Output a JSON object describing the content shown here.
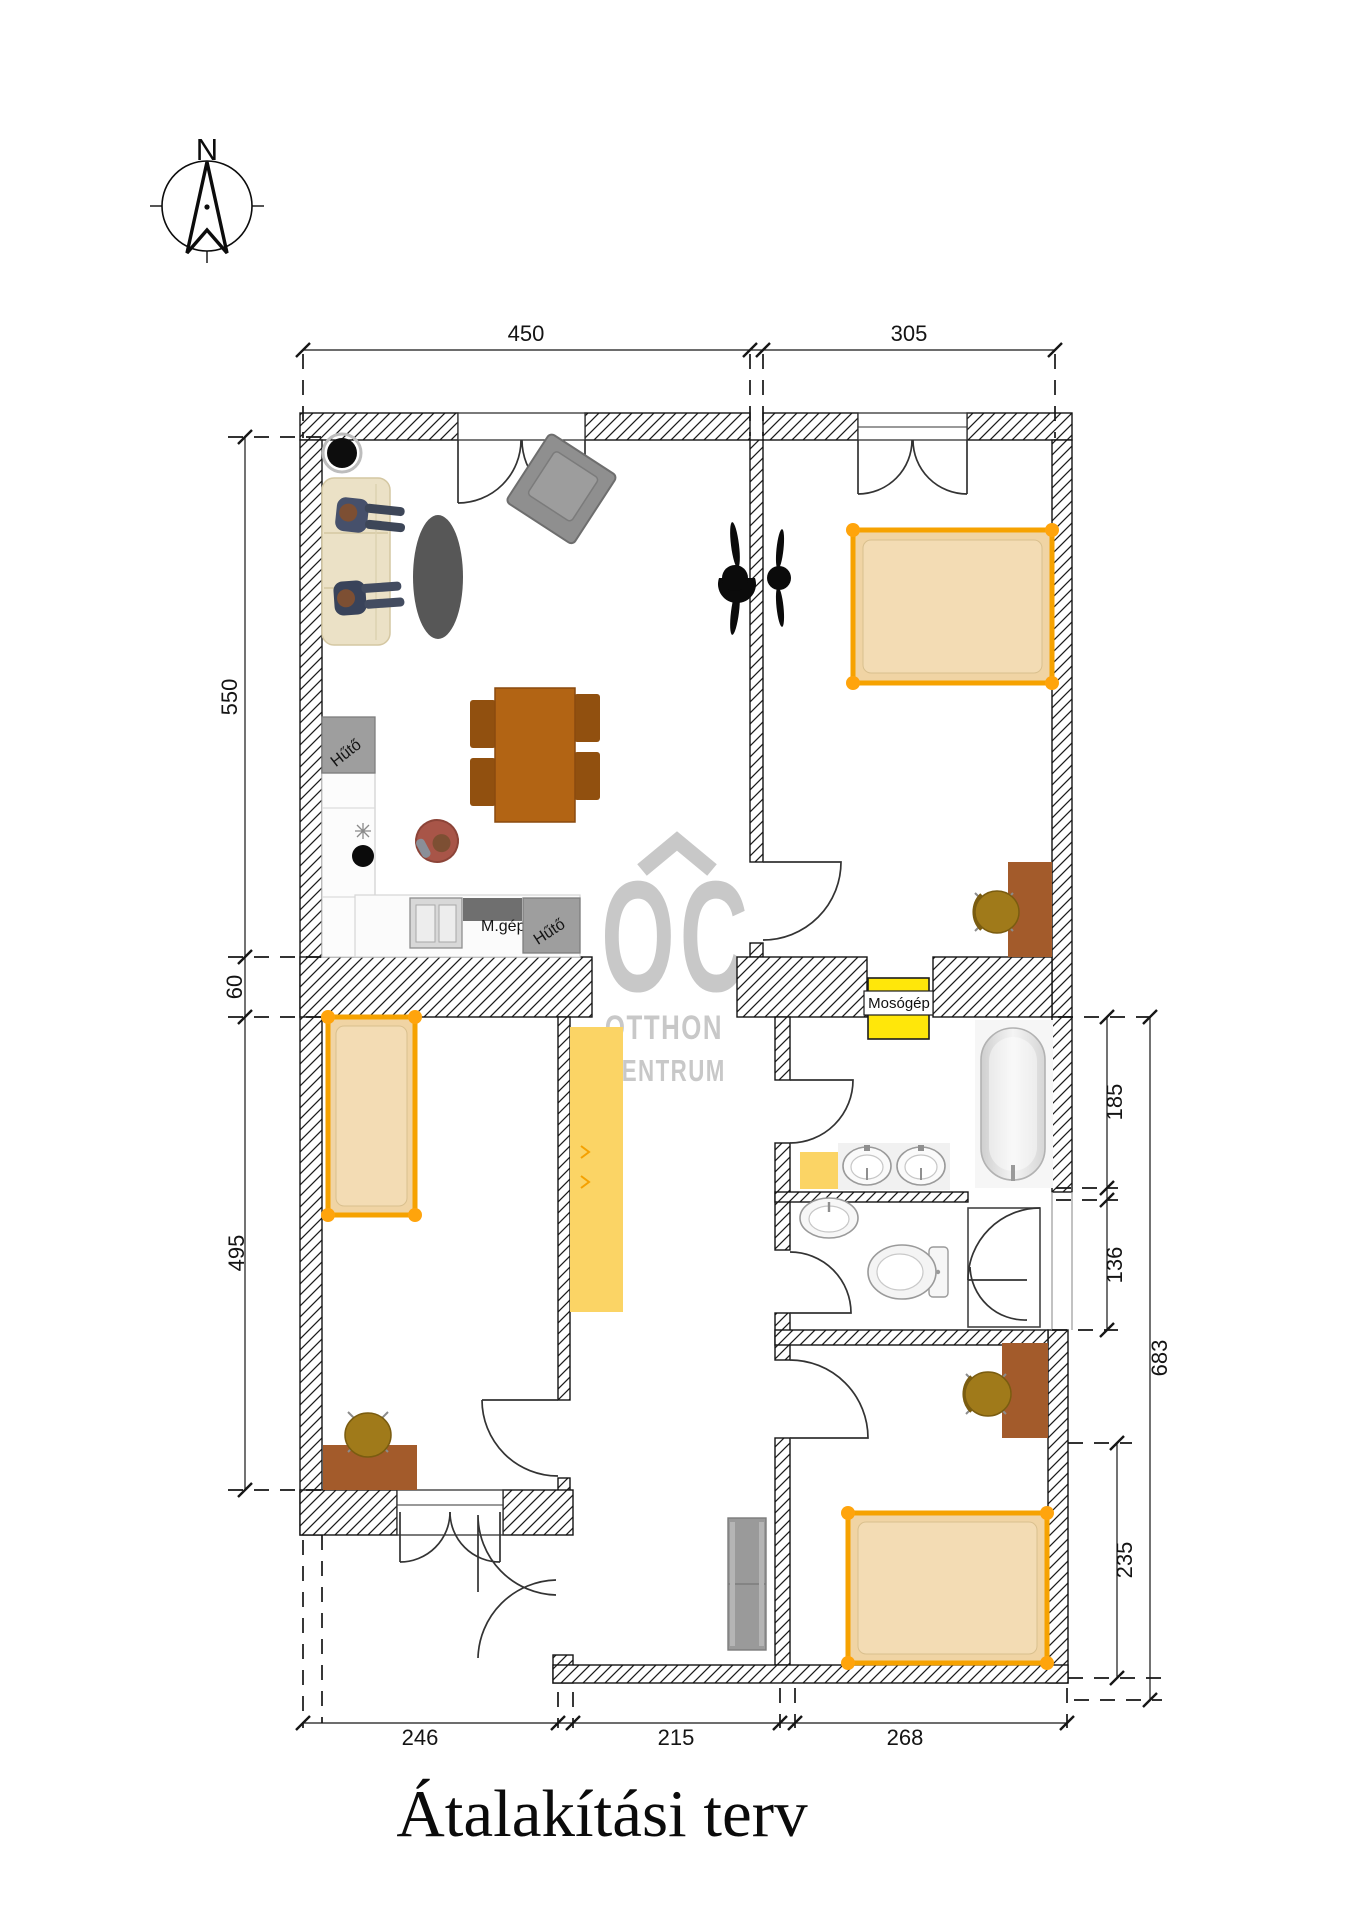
{
  "page": {
    "title_block": "Átalakítási terv"
  },
  "compass": {
    "north": "N"
  },
  "watermark": {
    "monogram": "OC",
    "line1": "OTTHON",
    "line2": "CENTRUM"
  },
  "appliance_labels": {
    "fridge_top": "Hűtő",
    "dishwasher": "M.gép",
    "fridge_bottom": "Hűtő",
    "washing_machine": "Mosógép"
  },
  "dimensions": {
    "top": [
      "450",
      "305"
    ],
    "left": [
      "550",
      "60",
      "495"
    ],
    "right": [
      "185",
      "136",
      "683",
      "235"
    ],
    "bottom": [
      "246",
      "215",
      "268"
    ]
  },
  "colors": {
    "bed_frame_orange": "#F6A200",
    "bed_fill_tan": "#F0D4A4",
    "wardrobe_yellow": "#FBD465",
    "washing_machine_yellow": "#FFE70A",
    "desk_brown": "#A35B2B",
    "table_brown": "#B26414",
    "chair_olive": "#A07A1A",
    "appliance_gray": "#9E9E9E",
    "watermark_gray": "#C6C6C6"
  }
}
